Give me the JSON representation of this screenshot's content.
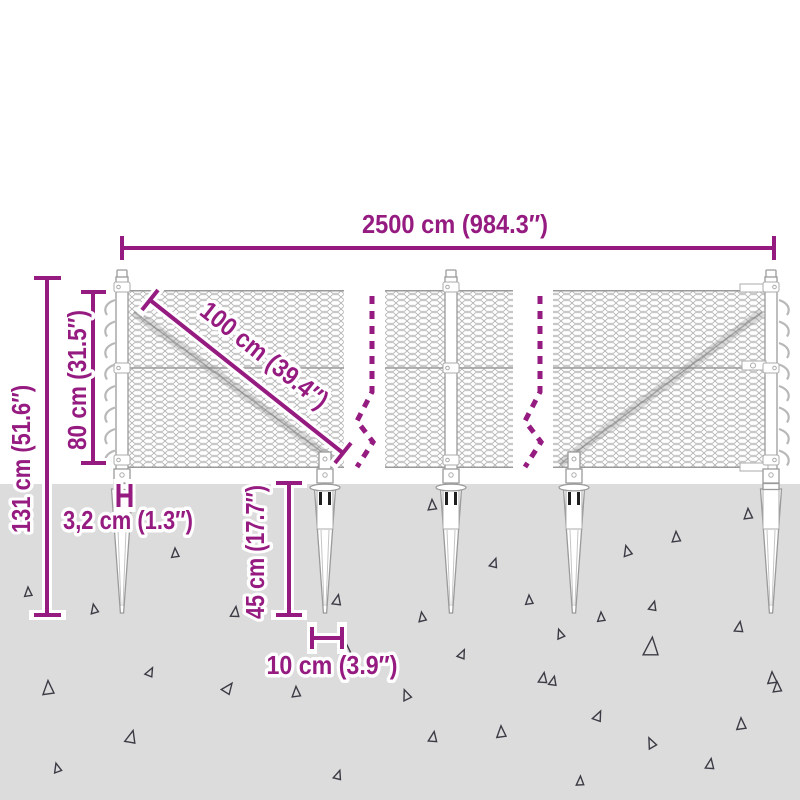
{
  "diagram": {
    "dimensions": {
      "total_width": "2500 cm (984.3″)",
      "panel_diagonal": "100 cm (39.4″)",
      "fence_height": "80 cm (31.5″)",
      "total_height": "131 cm (51.6″)",
      "post_width": "3,2 cm (1.3″)",
      "spike_depth": "45 cm (17.7″)",
      "spike_width": "10 cm (3.9″)"
    },
    "colors": {
      "dimension_accent": "#951b81",
      "ground": "#dcdcdc",
      "steel_outline": "#9a9a9a",
      "mesh_wire": "#b5b5b5",
      "gravel_triangle": "#3b3b45",
      "background": "#ffffff"
    }
  }
}
